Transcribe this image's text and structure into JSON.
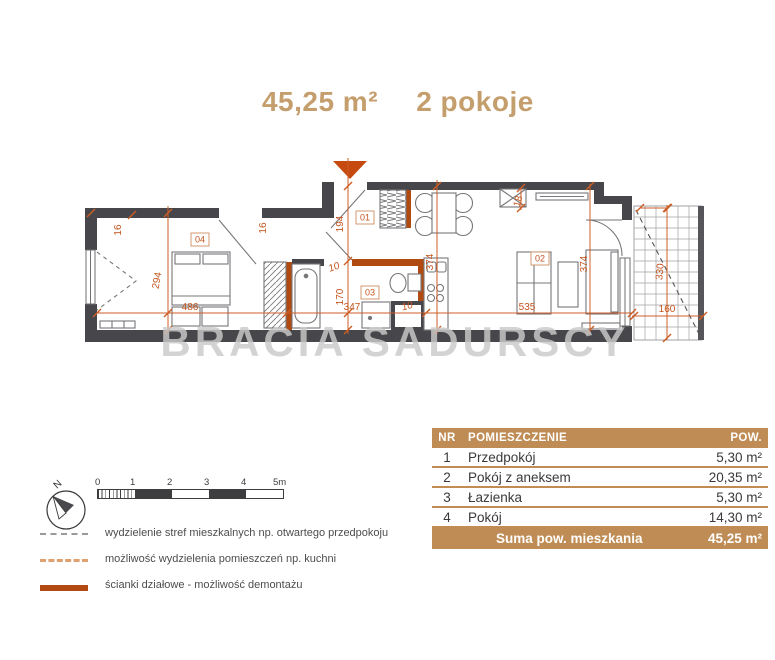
{
  "title": {
    "area": "45,25 m²",
    "rooms": "2 pokoje"
  },
  "watermark": "BRACIA SADURSCY",
  "colors": {
    "accent": "#c9551c",
    "partition": "#b04a10",
    "wall": "#47474b",
    "title": "#c59e6d",
    "table_header": "#bf8c55"
  },
  "plan": {
    "rooms": {
      "r01": "01",
      "r02": "02",
      "r03": "03",
      "r04": "04"
    },
    "dims": {
      "d16a": "16",
      "d294": "294",
      "d486": "486",
      "d16b": "16",
      "d194": "194",
      "d10a": "10",
      "d170": "170",
      "d374a": "374",
      "d347": "347",
      "d10b": "10",
      "d535": "535",
      "d18": "18",
      "d374b": "374",
      "d330": "330",
      "d160": "160"
    }
  },
  "legend": {
    "compass_label": "N",
    "scale_labels": [
      "0",
      "1",
      "2",
      "3",
      "4",
      "5m"
    ],
    "items": [
      {
        "label": "wydzielenie stref mieszkalnych np. otwartego przedpokoju"
      },
      {
        "label": "możliwość wydzielenia pomieszczeń np. kuchni"
      },
      {
        "label": "ścianki działowe - możliwość demontażu"
      }
    ]
  },
  "table": {
    "headers": {
      "nr": "NR",
      "name": "POMIESZCZENIE",
      "area": "POW."
    },
    "rows": [
      {
        "nr": "1",
        "name": "Przedpokój",
        "area": "5,30 m²"
      },
      {
        "nr": "2",
        "name": "Pokój z aneksem",
        "area": "20,35 m²"
      },
      {
        "nr": "3",
        "name": "Łazienka",
        "area": "5,30 m²"
      },
      {
        "nr": "4",
        "name": "Pokój",
        "area": "14,30 m²"
      }
    ],
    "footer": {
      "label": "Suma pow. mieszkania",
      "value": "45,25 m²"
    }
  }
}
